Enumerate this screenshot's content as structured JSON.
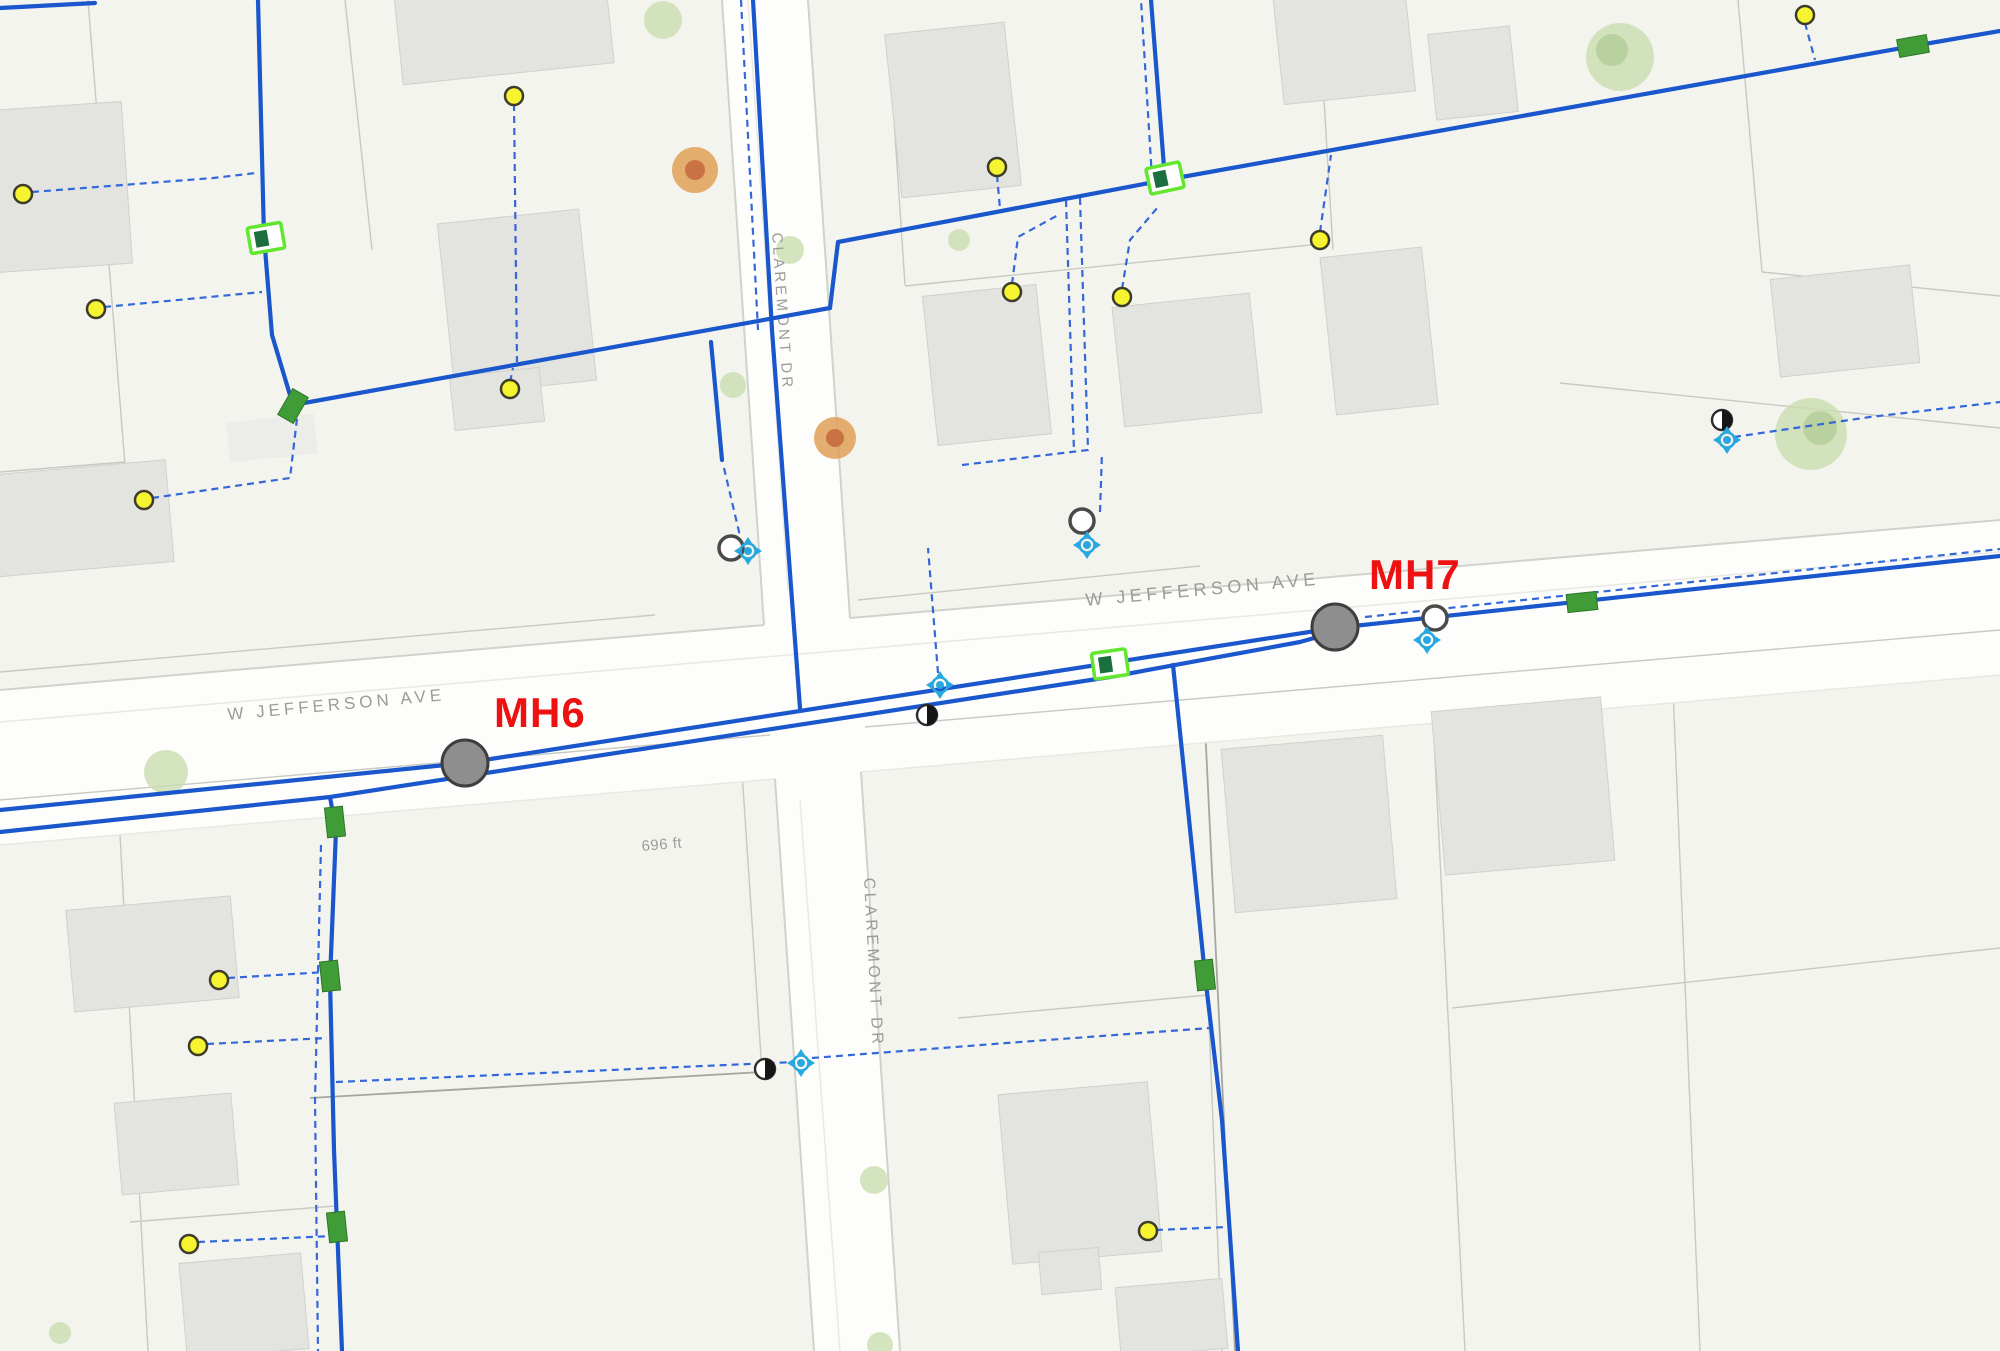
{
  "map": {
    "background": "#f4f4ef",
    "colors": {
      "water_main": "#1a57cc",
      "service_line": "#3468d8",
      "manhole_fill": "#8e8e8e",
      "manhole_label": "#ee1111",
      "street_label": "#9b9b97",
      "distance_label": "#a2a29a",
      "meter_point": "#f6f430",
      "valve_green": "#3f9c36",
      "station_green": "#62e62e",
      "hydrant_cyan": "#29a8e0",
      "tree_green": "#c9ddb0"
    },
    "text_labels": [
      {
        "name": "street-label-jefferson-west",
        "text": "W  JEFFERSON  AVE",
        "x": 228,
        "y": 720,
        "rotate": -5.2,
        "size": 17,
        "spacing": 4,
        "color_key": "street_label",
        "bold": false
      },
      {
        "name": "street-label-jefferson-east",
        "text": "W  JEFFERSON  AVE",
        "x": 1086,
        "y": 606,
        "rotate": -5.2,
        "size": 18,
        "spacing": 4.5,
        "color_key": "street_label",
        "bold": false
      },
      {
        "name": "street-label-claremont-north",
        "text": "CLAREMONT  DR",
        "x": 772,
        "y": 233,
        "rotate": 86,
        "size": 15,
        "spacing": 3.2,
        "color_key": "street_label",
        "bold": false
      },
      {
        "name": "street-label-claremont-south",
        "text": "CLAREMONT  DR",
        "x": 864,
        "y": 878,
        "rotate": 87,
        "size": 16,
        "spacing": 3.5,
        "color_key": "street_label",
        "bold": false
      },
      {
        "name": "distance-label",
        "text": "696 ft",
        "x": 642,
        "y": 851,
        "rotate": -5,
        "size": 15,
        "spacing": 0.5,
        "color_key": "distance_label",
        "bold": false
      }
    ],
    "features": {
      "manholes": [
        {
          "label": "MH6",
          "cx": 465,
          "cy": 763,
          "label_x": 494,
          "label_y": 727
        },
        {
          "label": "MH7",
          "cx": 1335,
          "cy": 627,
          "label_x": 1369,
          "label_y": 589
        }
      ],
      "service_points": [
        [
          23,
          194
        ],
        [
          96,
          309
        ],
        [
          144,
          500
        ],
        [
          514,
          96
        ],
        [
          510,
          389
        ],
        [
          997,
          167
        ],
        [
          1012,
          292
        ],
        [
          1122,
          297
        ],
        [
          1320,
          240
        ],
        [
          1805,
          15
        ],
        [
          219,
          980
        ],
        [
          198,
          1046
        ],
        [
          189,
          1244
        ],
        [
          1148,
          1231
        ]
      ],
      "cleanouts": [
        [
          731,
          548
        ],
        [
          1082,
          521
        ],
        [
          1435,
          618
        ]
      ],
      "fitting_nodes": [
        [
          927,
          715
        ],
        [
          765,
          1069
        ],
        [
          1722,
          420
        ]
      ],
      "hydrants": [
        [
          748,
          551
        ],
        [
          1087,
          545
        ],
        [
          940,
          685
        ],
        [
          801,
          1063
        ],
        [
          1727,
          440
        ],
        [
          1427,
          640
        ]
      ],
      "meter_stations": [
        {
          "cx": 266,
          "cy": 238,
          "rot": -10
        },
        {
          "cx": 1165,
          "cy": 178,
          "rot": -12
        },
        {
          "cx": 1110,
          "cy": 664,
          "rot": -8
        }
      ],
      "line_valves": [
        {
          "cx": 293,
          "cy": 406,
          "rot": 30
        },
        {
          "cx": 335,
          "cy": 822,
          "rot": -6
        },
        {
          "cx": 330,
          "cy": 976,
          "rot": -6
        },
        {
          "cx": 337,
          "cy": 1227,
          "rot": -6
        },
        {
          "cx": 1205,
          "cy": 975,
          "rot": -6
        },
        {
          "cx": 1582,
          "cy": 602,
          "rot": 84
        },
        {
          "cx": 1913,
          "cy": 46,
          "rot": 80
        }
      ]
    }
  }
}
